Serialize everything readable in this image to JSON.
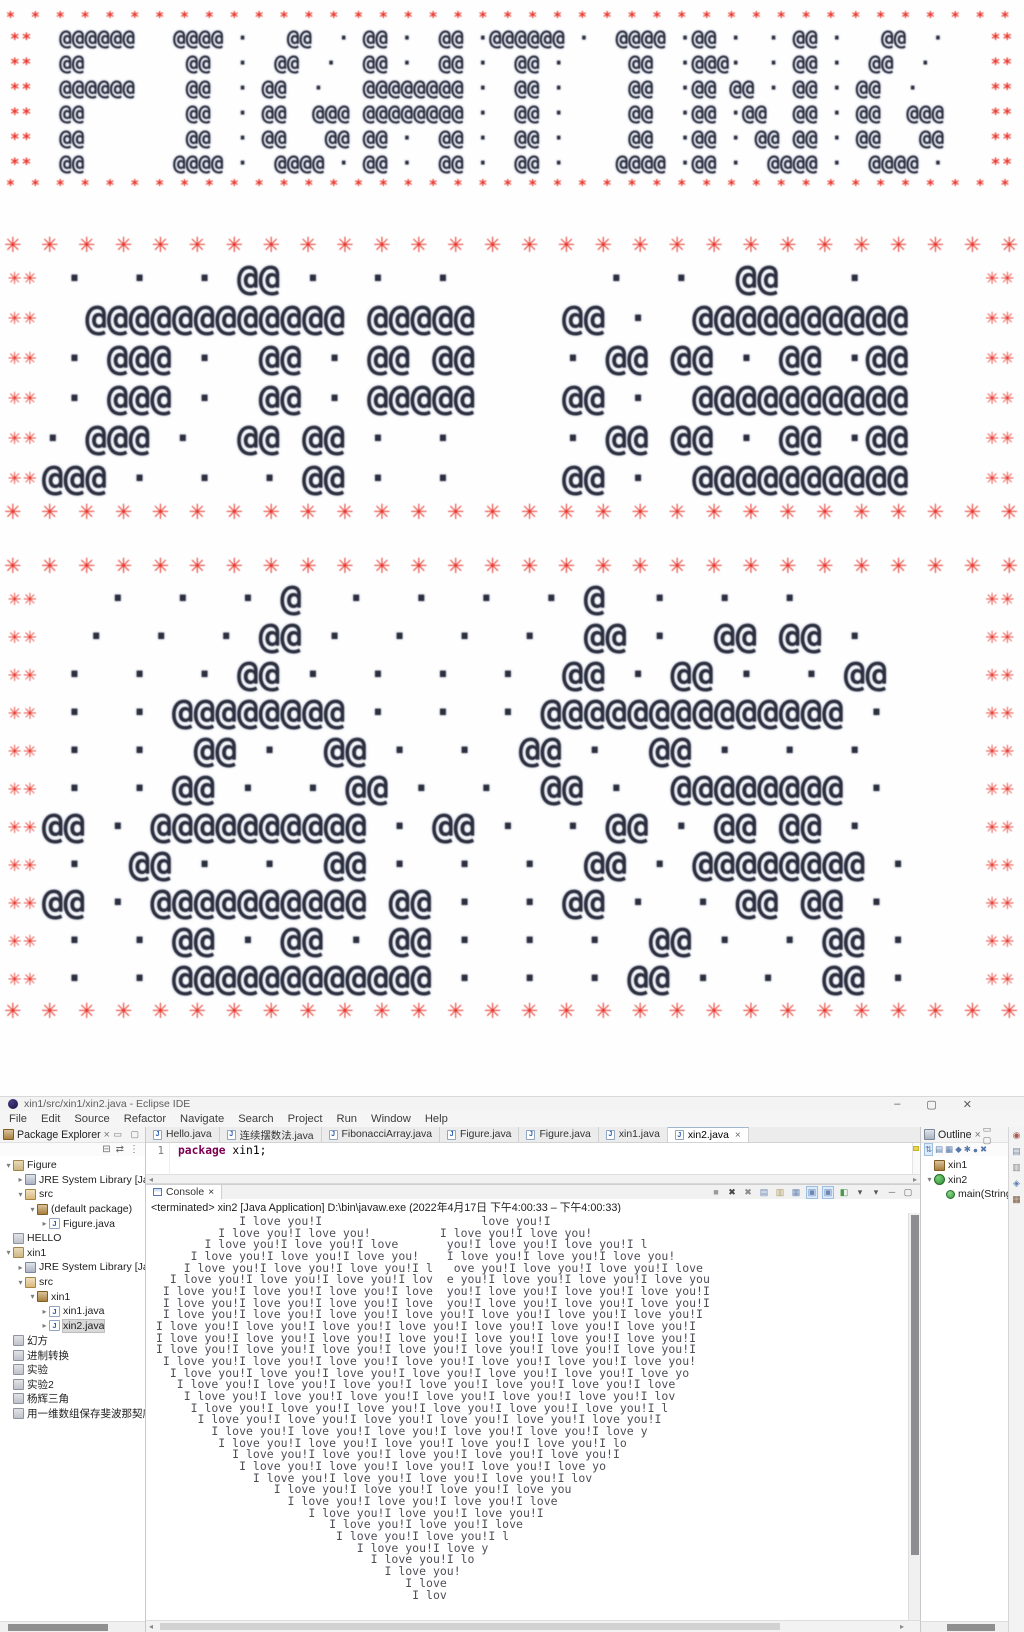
{
  "colors": {
    "red": "#e8352b",
    "ink": "#2c2f3e",
    "keyword": "#7b0052"
  },
  "ascii": {
    "block1": {
      "name": "fighting-banner",
      "border_char": "*",
      "side": "**",
      "rows": [
        "  @@@@@@   @@@@ ·   @@  · @@ ·  @@ ·@@@@@@ ·  @@@@ ·@@ ·  · @@ ·   @@  · ",
        "  @@        @@  ·  @@  ·  @@ ·  @@ ·  @@ ·     @@  ·@@@·  · @@ ·  @@  ·  ",
        "  @@@@@@    @@  · @@  ·   @@@@@@@@ ·  @@ ·     @@  ·@@ @@ · @@ · @@  ·   ",
        "  @@        @@  · @@  @@@ @@@@@@@@ ·  @@ ·     @@  ·@@ ·@@  @@ · @@  @@@ ",
        "  @@        @@  · @@   @@ @@ ·  @@ ·  @@ ·     @@  ·@@ · @@ @@ · @@   @@ ",
        "  @@       @@@@ ·  @@@@ · @@ ·  @@ ·  @@ ·    @@@@ ·@@ ·  @@@@ ·  @@@@ · "
      ]
    },
    "block2": {
      "name": "big-glyphs-banner-1",
      "border_char": "✳",
      "side": "✳✳",
      "rows": [
        " ·  ·  · @@ ·  ·  ·       ·  ·  @@   ·  ",
        "  @@@@@@@@@@@@ @@@@@    @@ ·  @@@@@@@@@@",
        " · @@@ ·  @@ · @@ @@    · @@ @@ · @@ ·@@",
        " · @@@ ·  @@ · @@@@@    @@ ·  @@@@@@@@@@",
        "· @@@ ·  @@ @@ ·  ·     · @@ @@ · @@ ·@@",
        "@@@ ·  ·  · @@ ·  ·     @@ ·  @@@@@@@@@@"
      ]
    },
    "block3": {
      "name": "big-glyphs-banner-2",
      "border_char": "✳",
      "side": "✳✳",
      "rows": [
        "   ·  ·  · @  ·  ·  ·  · @  ·  ·  ·    ",
        "  ·  ·  · @@ ·  ·  ·  ·  @@ ·  @@ @@ ·  ",
        " ·  ·  · @@ ·  ·  ·  ·  @@ · @@ ·  · @@ ",
        " ·  · @@@@@@@@ ·  ·  · @@@@@@@@@@@@@@ · ",
        " ·  ·  @@ ·  @@ ·  ·  @@ ·  @@ ·  ·  ·  ",
        " ·  · @@ ·  · @@ ·  ·  @@ ·  @@@@@@@@ · ",
        "@@ · @@@@@@@@@@ · @@ ·  · @@ · @@ @@ ·  ",
        " ·  @@ ·  ·  @@ ·  ·  ·  @@ · @@@@@@@@ ·",
        "@@ · @@@@@@@@@@ @@ ·  · @@ ·  · @@ @@ · ",
        " ·  · @@ · @@ · @@ ·  ·  ·  @@ ·  · @@ ·",
        " ·  · @@@@@@@@@@@@ ·  ·  · @@ ·  ·  @@ ·"
      ]
    }
  },
  "ide": {
    "titlebar": {
      "title": "xin1/src/xin1/xin2.java - Eclipse IDE",
      "minimize": "–",
      "maximize": "▢",
      "close": "✕"
    },
    "menubar": [
      "File",
      "Edit",
      "Source",
      "Refactor",
      "Navigate",
      "Search",
      "Project",
      "Run",
      "Window",
      "Help"
    ],
    "package_explorer": {
      "title": "Package Explorer",
      "close_glyph": "×",
      "min_glyphs": "▭ ▢",
      "toolbar_icons": [
        {
          "name": "collapse-all-icon",
          "glyph": "⊟"
        },
        {
          "name": "link-with-editor-icon",
          "glyph": "⇄"
        },
        {
          "name": "view-menu-icon",
          "glyph": "⋮"
        }
      ],
      "items": [
        {
          "label": "Figure",
          "depth": 0,
          "icon": "project",
          "arrow": "expanded"
        },
        {
          "label": "JRE System Library [Java",
          "depth": 1,
          "icon": "library",
          "arrow": "collapsed"
        },
        {
          "label": "src",
          "depth": 1,
          "icon": "src",
          "arrow": "expanded"
        },
        {
          "label": "(default package)",
          "depth": 2,
          "icon": "pkg",
          "arrow": "expanded"
        },
        {
          "label": "Figure.java",
          "depth": 3,
          "icon": "java",
          "arrow": "collapsed"
        },
        {
          "label": "HELLO",
          "depth": 0,
          "icon": "project-closed",
          "arrow": "none"
        },
        {
          "label": "xin1",
          "depth": 0,
          "icon": "project",
          "arrow": "expanded"
        },
        {
          "label": "JRE System Library [Java",
          "depth": 1,
          "icon": "library",
          "arrow": "collapsed"
        },
        {
          "label": "src",
          "depth": 1,
          "icon": "src",
          "arrow": "expanded"
        },
        {
          "label": "xin1",
          "depth": 2,
          "icon": "pkg",
          "arrow": "expanded"
        },
        {
          "label": "xin1.java",
          "depth": 3,
          "icon": "java",
          "arrow": "collapsed"
        },
        {
          "label": "xin2.java",
          "depth": 3,
          "icon": "java",
          "arrow": "collapsed",
          "selected": true
        },
        {
          "label": "幻方",
          "depth": 0,
          "icon": "project-closed",
          "arrow": "none"
        },
        {
          "label": "进制转换",
          "depth": 0,
          "icon": "project-closed",
          "arrow": "none"
        },
        {
          "label": "实验",
          "depth": 0,
          "icon": "project-closed",
          "arrow": "none"
        },
        {
          "label": "实验2",
          "depth": 0,
          "icon": "project-closed",
          "arrow": "none"
        },
        {
          "label": "杨辉三角",
          "depth": 0,
          "icon": "project-closed",
          "arrow": "none"
        },
        {
          "label": "用一维数组保存斐波那契序列",
          "depth": 0,
          "icon": "project-closed",
          "arrow": "none"
        }
      ]
    },
    "editor": {
      "tabs": [
        {
          "label": "Hello.java"
        },
        {
          "label": "连续摆数法.java"
        },
        {
          "label": "FibonacciArray.java"
        },
        {
          "label": "Figure.java"
        },
        {
          "label": "Figure.java"
        },
        {
          "label": "xin1.java"
        },
        {
          "label": "xin2.java",
          "active": true,
          "close": "×"
        }
      ],
      "line_number": "1",
      "keyword": "package",
      "code_rest": " xin1;"
    },
    "outline": {
      "title": "Outline",
      "close_glyph": "×",
      "min_glyphs": "▭ ▢",
      "toolbar_icons": [
        {
          "name": "sort-icon",
          "glyph": "⇅",
          "boxed": true
        },
        {
          "name": "hide-fields-icon",
          "glyph": "▤"
        },
        {
          "name": "hide-static-icon",
          "glyph": "▦"
        },
        {
          "name": "hide-nonpublic-icon",
          "glyph": "◆"
        },
        {
          "name": "hide-local-icon",
          "glyph": "✱"
        },
        {
          "name": "focus-icon",
          "glyph": "●"
        },
        {
          "name": "link-icon",
          "glyph": "✖"
        }
      ],
      "items": [
        {
          "label": "xin1",
          "depth": 0,
          "icon": "pkg",
          "arrow": "none"
        },
        {
          "label": "xin2",
          "depth": 0,
          "icon": "class",
          "arrow": "expanded"
        },
        {
          "label": "main(String",
          "depth": 1,
          "icon": "method",
          "arrow": "none"
        }
      ]
    },
    "console": {
      "tab": "Console",
      "close_glyph": "×",
      "status": "<terminated> xin2 [Java Application] D:\\bin\\javaw.exe  (2022年4月17日 下午4:00:33 – 下午4:00:33)",
      "toolbar_icons": [
        {
          "name": "terminate-icon",
          "glyph": "■",
          "color": "#9a9a9a"
        },
        {
          "name": "remove-launch-icon",
          "glyph": "✖",
          "color": "#444444"
        },
        {
          "name": "remove-all-icon",
          "glyph": "✖",
          "color": "#8a8a8a"
        },
        {
          "name": "clear-console-icon",
          "glyph": "▤",
          "color": "#6a87b5"
        },
        {
          "name": "scroll-lock-icon",
          "glyph": "▥",
          "color": "#b09a62"
        },
        {
          "name": "word-wrap-icon",
          "glyph": "▦",
          "color": "#6a87b5"
        },
        {
          "name": "show-stdout-icon",
          "glyph": "▣",
          "color": "#6a87b5",
          "boxed": true
        },
        {
          "name": "show-stderr-icon",
          "glyph": "▣",
          "color": "#6a87b5",
          "boxed": true
        },
        {
          "name": "pin-console-icon",
          "glyph": "◧",
          "color": "#4a9a4a"
        },
        {
          "name": "display-console-icon",
          "glyph": "▾",
          "color": "#555555"
        },
        {
          "name": "open-console-icon",
          "glyph": "▾",
          "color": "#555555"
        },
        {
          "name": "minimize-view-icon",
          "glyph": "─",
          "color": "#666666"
        },
        {
          "name": "maximize-view-icon",
          "glyph": "▢",
          "color": "#666666"
        }
      ],
      "lines": [
        "            I love you!I                       love you!I",
        "         I love you!I love you!          I love you!I love you!",
        "       I love you!I love you!I love       you!I love you!I love you!I l",
        "     I love you!I love you!I love you!    I love you!I love you!I love you!",
        "    I love you!I love you!I love you!I l   ove you!I love you!I love you!I love",
        "  I love you!I love you!I love you!I lov  e you!I love you!I love you!I love you",
        " I love you!I love you!I love you!I love  you!I love you!I love you!I love you!I",
        " I love you!I love you!I love you!I love  you!I love you!I love you!I love you!I",
        " I love you!I love you!I love you!I love you!I love you!I love you!I love you!I",
        "I love you!I love you!I love you!I love you!I love you!I love you!I love you!I",
        "I love you!I love you!I love you!I love you!I love you!I love you!I love you!I",
        "I love you!I love you!I love you!I love you!I love you!I love you!I love you!I",
        " I love you!I love you!I love you!I love you!I love you!I love you!I love you!",
        "  I love you!I love you!I love you!I love you!I love you!I love you!I love yo",
        "   I love you!I love you!I love you!I love you!I love you!I love you!I love",
        "    I love you!I love you!I love you!I love you!I love you!I love you!I lov",
        "     I love you!I love you!I love you!I love you!I love you!I love you!I l",
        "      I love you!I love you!I love you!I love you!I love you!I love you!I",
        "        I love you!I love you!I love you!I love you!I love you!I love y",
        "         I love you!I love you!I love you!I love you!I love you!I lo",
        "           I love you!I love you!I love you!I love you!I love you!I",
        "            I love you!I love you!I love you!I love you!I love yo",
        "              I love you!I love you!I love you!I love you!I lov",
        "                 I love you!I love you!I love you!I love you",
        "                   I love you!I love you!I love you!I love",
        "                      I love you!I love you!I love you!I",
        "                         I love you!I love you!I love",
        "                          I love you!I love you!I l",
        "                             I love you!I love y",
        "                               I love you!I lo",
        "                                 I love you!",
        "                                    I love",
        "                                     I lov"
      ]
    }
  }
}
